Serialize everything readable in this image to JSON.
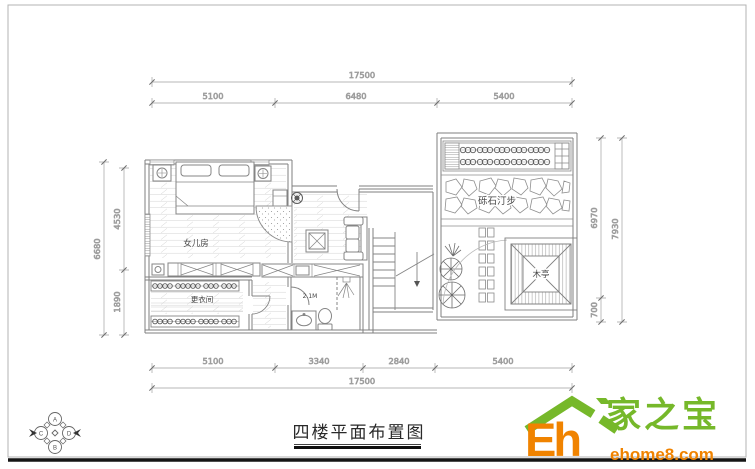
{
  "drawing": {
    "title": "四楼平面布置图",
    "labels": {
      "daughter_room": "女儿房",
      "dressing_room": "更衣间",
      "bath_ceiling": "2.1M",
      "gravel_path": "砾石汀步",
      "pavilion": "木亭"
    },
    "dims": {
      "top": {
        "total": "17500",
        "seg1": "5100",
        "seg2": "6480",
        "seg3": "5400"
      },
      "bottom": {
        "total": "17500",
        "seg1": "5100",
        "seg2": "3340",
        "seg3": "2840",
        "seg4": "5400"
      },
      "left": {
        "total": "6680",
        "seg1": "4530",
        "seg2": "1890"
      },
      "right": {
        "total": "7930",
        "seg1": "6970",
        "seg2": "700"
      }
    },
    "compass": {
      "a": "A",
      "b": "B",
      "c": "C",
      "d": "D"
    }
  },
  "logo": {
    "eh": "Eh",
    "brand": "家之宝",
    "site": "ehome8.com",
    "green": "#76b82a",
    "orange": "#f08300"
  }
}
